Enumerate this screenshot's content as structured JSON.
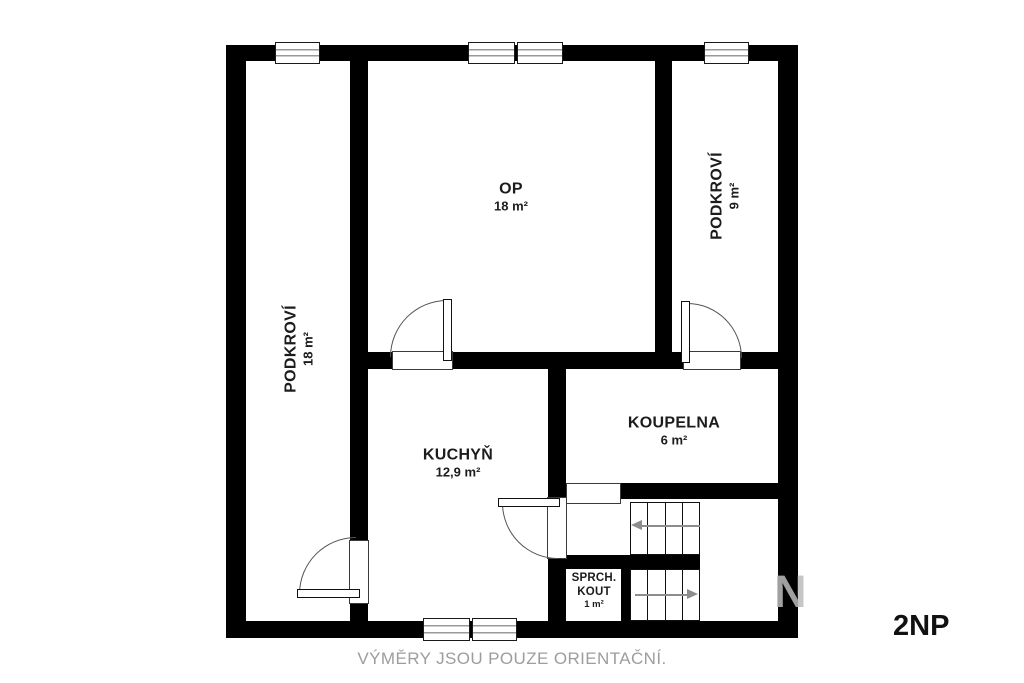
{
  "title": "2NP",
  "caption": "VÝMĚRY JSOU POUZE ORIENTAČNÍ.",
  "watermark": "N",
  "rooms": {
    "op": {
      "name": "OP",
      "area": "18 m²"
    },
    "podkrovi_right": {
      "name": "PODKROVÍ",
      "area": "9 m²"
    },
    "podkrovi_left": {
      "name": "PODKROVÍ",
      "area": "18 m²"
    },
    "kuchyn": {
      "name": "KUCHYŇ",
      "area": "12,9 m²"
    },
    "koupelna": {
      "name": "KOUPELNA",
      "area": "6 m²"
    },
    "sprch_kout": {
      "name": "SPRCH. KOUT",
      "area": "1 m²"
    }
  },
  "colors": {
    "wall": "#000000",
    "stair_arrow": "#8d8d8d",
    "caption_text": "#9d9d9d"
  }
}
